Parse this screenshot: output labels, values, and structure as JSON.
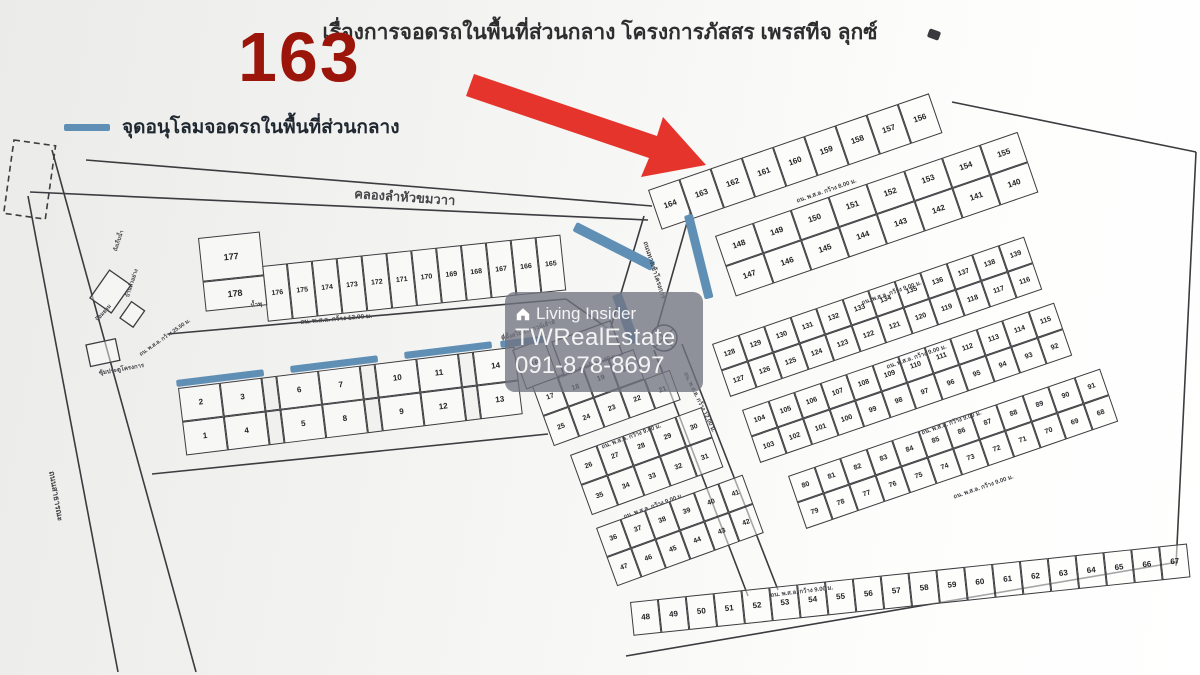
{
  "title": "เรื่องการจอดรถในพื้นที่ส่วนกลาง โครงการภัสสร เพรสทีจ ลุกซ์",
  "overlay": {
    "big_number": "163",
    "big_number_color": "#9c150b"
  },
  "legend": {
    "label": "จุดอนุโลมจอดรถในพื้นที่ส่วนกลาง"
  },
  "watermark": {
    "brand": "Living Insider",
    "agency": "TWRealEstate",
    "phone": "091-878-8697"
  },
  "map": {
    "ink": "#3c3c40",
    "parking_color": "#5f8fb4",
    "arrow_color": "#e5342c",
    "strips": [
      {
        "id": "row-176-165",
        "x": 262,
        "y": 266,
        "angle": -6,
        "cw": 25,
        "ch": 56,
        "fs": 7,
        "rows": [
          [
            "176",
            "175",
            "174",
            "173",
            "172",
            "171",
            "170",
            "169",
            "168",
            "167",
            "166",
            "165"
          ]
        ]
      },
      {
        "id": "pair-177-178",
        "x": 198,
        "y": 238,
        "angle": -6,
        "cw": 62,
        "ch": 44,
        "fs": 9,
        "rhs": [
          44,
          30
        ],
        "rows": [
          [
            "177"
          ],
          [
            "178"
          ]
        ]
      },
      {
        "id": "row-1-14",
        "x": 178,
        "y": 388,
        "angle": -7,
        "cw": 42,
        "ch": 34,
        "fs": 8,
        "sep": 15,
        "rows": [
          [
            "2",
            "3",
            "|",
            "6",
            "7",
            "|",
            "10",
            "11",
            "|",
            "14"
          ],
          [
            "1",
            "4",
            "|",
            "5",
            "8",
            "|",
            "9",
            "12",
            "|",
            "13"
          ]
        ]
      },
      {
        "id": "plot-16",
        "x": 512,
        "y": 350,
        "angle": -20,
        "cw": 34,
        "ch": 42,
        "fs": 8,
        "rows": [
          [
            "16"
          ]
        ]
      },
      {
        "id": "t1",
        "x": 532,
        "y": 386,
        "angle": -20,
        "cw": 27,
        "ch": 32,
        "fs": 7,
        "rows": [
          [
            "17",
            "18",
            "19",
            "20"
          ],
          [
            "25",
            "24",
            "23",
            "22",
            "21"
          ]
        ]
      },
      {
        "id": "t2",
        "x": 570,
        "y": 455,
        "angle": -20,
        "cw": 28,
        "ch": 32,
        "fs": 7,
        "rows": [
          [
            "26",
            "27",
            "28",
            "29",
            "30"
          ],
          [
            "35",
            "34",
            "33",
            "32",
            "31"
          ]
        ]
      },
      {
        "id": "t3",
        "x": 596,
        "y": 528,
        "angle": -20,
        "cw": 26,
        "ch": 31,
        "fs": 7,
        "rows": [
          [
            "36",
            "37",
            "38",
            "39",
            "40",
            "41"
          ],
          [
            "47",
            "46",
            "45",
            "44",
            "43",
            "42"
          ]
        ]
      },
      {
        "id": "s1",
        "x": 648,
        "y": 190,
        "angle": -19,
        "cw": 33,
        "ch": 42,
        "fs": 8,
        "rows": [
          [
            "164",
            "163",
            "162",
            "161",
            "160",
            "159",
            "158",
            "157",
            "156"
          ]
        ]
      },
      {
        "id": "s2",
        "x": 715,
        "y": 236,
        "angle": -19,
        "cw": 40,
        "ch": 32,
        "fs": 8,
        "rows": [
          [
            "148",
            "149",
            "150",
            "151",
            "152",
            "153",
            "154",
            "155"
          ],
          [
            "147",
            "146",
            "145",
            "144",
            "143",
            "142",
            "141",
            "140"
          ]
        ]
      },
      {
        "id": "s3",
        "x": 712,
        "y": 344,
        "angle": -19,
        "cw": 27.5,
        "ch": 28,
        "fs": 7,
        "rows": [
          [
            "128",
            "129",
            "130",
            "131",
            "132",
            "133",
            "134",
            "135",
            "136",
            "137",
            "138",
            "139"
          ],
          [
            "127",
            "126",
            "125",
            "124",
            "123",
            "122",
            "121",
            "120",
            "119",
            "118",
            "117",
            "116"
          ]
        ]
      },
      {
        "id": "s4",
        "x": 742,
        "y": 410,
        "angle": -19,
        "cw": 27.5,
        "ch": 28,
        "fs": 7,
        "rows": [
          [
            "104",
            "105",
            "106",
            "107",
            "108",
            "109",
            "110",
            "111",
            "112",
            "113",
            "114",
            "115"
          ],
          [
            "103",
            "102",
            "101",
            "100",
            "99",
            "98",
            "97",
            "96",
            "95",
            "94",
            "93",
            "92"
          ]
        ]
      },
      {
        "id": "s5",
        "x": 788,
        "y": 476,
        "angle": -19,
        "cw": 27.5,
        "ch": 28,
        "fs": 7,
        "rows": [
          [
            "80",
            "81",
            "82",
            "83",
            "84",
            "85",
            "86",
            "87",
            "88",
            "89",
            "90",
            "91"
          ],
          [
            "79",
            "78",
            "77",
            "76",
            "75",
            "74",
            "73",
            "72",
            "71",
            "70",
            "69",
            "68"
          ]
        ]
      },
      {
        "id": "s6",
        "x": 630,
        "y": 602,
        "angle": -6,
        "cw": 28,
        "ch": 34,
        "fs": 8,
        "rows": [
          [
            "48",
            "49",
            "50",
            "51",
            "52",
            "53",
            "54",
            "55",
            "56",
            "57",
            "58",
            "59",
            "60",
            "61",
            "62",
            "63",
            "64",
            "65",
            "66",
            "67"
          ]
        ]
      }
    ],
    "zones": [
      {
        "x": 176,
        "y": 380,
        "w": 88,
        "h": 7,
        "angle": -7
      },
      {
        "x": 290,
        "y": 366,
        "w": 88,
        "h": 7,
        "angle": -7
      },
      {
        "x": 404,
        "y": 352,
        "w": 88,
        "h": 7,
        "angle": -7
      },
      {
        "x": 500,
        "y": 341,
        "w": 46,
        "h": 7,
        "angle": -7
      },
      {
        "x": 577,
        "y": 222,
        "w": 88,
        "h": 10,
        "angle": 27
      },
      {
        "x": 684,
        "y": 216,
        "w": 9,
        "h": 86,
        "angle": -14
      },
      {
        "x": 612,
        "y": 296,
        "w": 10,
        "h": 52,
        "angle": -20
      }
    ],
    "lines": [
      {
        "x1": 86,
        "y1": 160,
        "x2": 652,
        "y2": 206
      },
      {
        "x1": 30,
        "y1": 192,
        "x2": 648,
        "y2": 220
      },
      {
        "x1": 28,
        "y1": 196,
        "x2": 118,
        "y2": 672
      },
      {
        "x1": 52,
        "y1": 150,
        "x2": 196,
        "y2": 672
      },
      {
        "x1": 168,
        "y1": 334,
        "x2": 566,
        "y2": 299
      },
      {
        "x1": 152,
        "y1": 474,
        "x2": 548,
        "y2": 434
      },
      {
        "x1": 644,
        "y1": 216,
        "x2": 610,
        "y2": 330
      },
      {
        "x1": 690,
        "y1": 212,
        "x2": 656,
        "y2": 332
      },
      {
        "x1": 654,
        "y1": 350,
        "x2": 748,
        "y2": 596
      },
      {
        "x1": 682,
        "y1": 344,
        "x2": 778,
        "y2": 590
      },
      {
        "x1": 952,
        "y1": 102,
        "x2": 1196,
        "y2": 152
      },
      {
        "x1": 1196,
        "y1": 152,
        "x2": 1176,
        "y2": 566
      },
      {
        "x1": 626,
        "y1": 656,
        "x2": 1178,
        "y2": 562
      },
      {
        "x1": 566,
        "y1": 299,
        "x2": 610,
        "y2": 330
      }
    ],
    "boxes": [
      {
        "x": 90,
        "y": 298,
        "w": 34,
        "h": 26,
        "angle": -55
      },
      {
        "x": 86,
        "y": 345,
        "w": 30,
        "h": 22,
        "angle": -12
      },
      {
        "x": 120,
        "y": 318,
        "w": 20,
        "h": 16,
        "angle": -55
      },
      {
        "x": 552,
        "y": 342,
        "w": 62,
        "h": 36,
        "angle": -20
      }
    ],
    "dash_rect": {
      "x": 14,
      "y": 140,
      "w": 42,
      "h": 74,
      "angle": 8
    },
    "roundabout": {
      "x": 664,
      "y": 338,
      "r": 13
    },
    "labels": [
      {
        "text": "คลองลำหัวขมวาา",
        "x": 355,
        "y": 183,
        "angle": 4,
        "size": 13
      },
      {
        "text": "ถน. พ.ส.ล. กว้าง 13.00 ม.",
        "x": 300,
        "y": 317,
        "angle": -5,
        "size": 6.5
      },
      {
        "text": "ถน. พ.ส.ล. กว้าง 8.00 ม.",
        "x": 795,
        "y": 196,
        "angle": -19,
        "size": 6
      },
      {
        "text": "ถน. พ.ส.ล. กว้าง 9.00 ม.",
        "x": 860,
        "y": 298,
        "angle": -19,
        "size": 6
      },
      {
        "text": "ถน. พ.ส.ล. กว้าง 9.00 ม.",
        "x": 885,
        "y": 362,
        "angle": -19,
        "size": 6
      },
      {
        "text": "ถน. พ.ส.ล. กว้าง 9.00 ม.",
        "x": 920,
        "y": 428,
        "angle": -19,
        "size": 6
      },
      {
        "text": "ถน. พ.ส.ล. กว้าง 9.00 ม.",
        "x": 952,
        "y": 492,
        "angle": -19,
        "size": 6
      },
      {
        "text": "ถน. พ.ส.ล. กว้าง 9.00 ม.",
        "x": 770,
        "y": 590,
        "angle": -7,
        "size": 6
      },
      {
        "text": "ถน. พ.ส.ล. กว้าง 9.00 ม.",
        "x": 556,
        "y": 372,
        "angle": -20,
        "size": 6
      },
      {
        "text": "ถน. พ.ส.ล. กว้าง 9.00 ม.",
        "x": 600,
        "y": 442,
        "angle": -20,
        "size": 6
      },
      {
        "text": "ถน. พ.ส.ล. กว้าง 9.00 ม.",
        "x": 622,
        "y": 512,
        "angle": -20,
        "size": 6
      },
      {
        "text": "ถน. พ.ส.ล. กว้าง 12.00 ม.",
        "x": 690,
        "y": 370,
        "angle": 64,
        "size": 6
      },
      {
        "text": "ถนนทางเข้าโครงการ",
        "x": 650,
        "y": 240,
        "angle": 72,
        "size": 6.5
      },
      {
        "text": "ถนนสาธารณะ",
        "x": 58,
        "y": 470,
        "angle": 80,
        "size": 8
      },
      {
        "text": "ป้อมยาม",
        "x": 94,
        "y": 318,
        "angle": -48,
        "size": 5.5
      },
      {
        "text": "ซุ้มประตูโครงการ",
        "x": 98,
        "y": 368,
        "angle": -10,
        "size": 6
      },
      {
        "text": "น้ำพุ",
        "x": 250,
        "y": 300,
        "angle": -7,
        "size": 6
      },
      {
        "text": "ที่ตั้งสโมสรทาวน์เฮ้าส์",
        "x": 500,
        "y": 334,
        "angle": -18,
        "size": 6
      },
      {
        "text": "ถังเก็บน้ำ",
        "x": 112,
        "y": 250,
        "angle": -72,
        "size": 5.5
      },
      {
        "text": "บ้านตัวอย่าง",
        "x": 124,
        "y": 296,
        "angle": -72,
        "size": 5.5
      },
      {
        "text": "ถน. พ.ส.ล. กว้าง 25.50 ม.",
        "x": 138,
        "y": 352,
        "angle": -35,
        "size": 5.5
      }
    ]
  }
}
